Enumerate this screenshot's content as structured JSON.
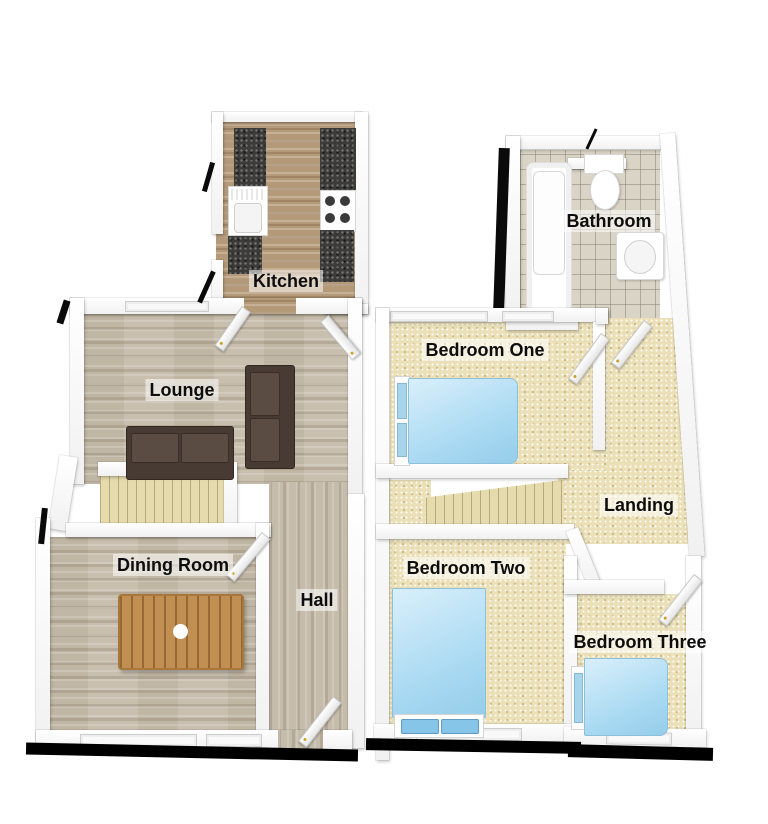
{
  "floorplan": {
    "style": "3d-rendered-floorplan",
    "floors": [
      {
        "id": "ground-floor",
        "rooms": [
          {
            "id": "kitchen",
            "label": "Kitchen",
            "floor_finish": "wood",
            "furniture": [
              "worktop",
              "kitchen-sink",
              "hob"
            ]
          },
          {
            "id": "lounge",
            "label": "Lounge",
            "floor_finish": "wood",
            "furniture": [
              "sofa-large",
              "sofa-small"
            ]
          },
          {
            "id": "dining-room",
            "label": "Dining Room",
            "floor_finish": "wood",
            "furniture": [
              "dining-table"
            ]
          },
          {
            "id": "hall",
            "label": "Hall",
            "floor_finish": "wood",
            "furniture": [
              "staircase",
              "front-door"
            ]
          }
        ]
      },
      {
        "id": "first-floor",
        "rooms": [
          {
            "id": "bathroom",
            "label": "Bathroom",
            "floor_finish": "tile",
            "furniture": [
              "bathtub",
              "toilet",
              "wash-basin"
            ]
          },
          {
            "id": "bedroom-one",
            "label": "Bedroom One",
            "floor_finish": "carpet",
            "furniture": [
              "double-bed"
            ]
          },
          {
            "id": "landing",
            "label": "Landing",
            "floor_finish": "carpet",
            "furniture": [
              "staircase"
            ]
          },
          {
            "id": "bedroom-two",
            "label": "Bedroom Two",
            "floor_finish": "carpet",
            "furniture": [
              "double-bed"
            ]
          },
          {
            "id": "bedroom-three",
            "label": "Bedroom Three",
            "floor_finish": "carpet",
            "furniture": [
              "single-bed"
            ]
          }
        ]
      }
    ],
    "colors": {
      "background": "#ffffff",
      "wall": "#ffffff",
      "wall_shade": "#f1f1f1",
      "outline_shadow": "#000000",
      "wood_floor": "#c8bfae",
      "kitchen_floor": "#b59a79",
      "carpet": "#eadfb6",
      "tile": "#d9d4c6",
      "stairs": "#e6dbad",
      "bed_blue": "#a8d9f2",
      "sofa_brown": "#473b33",
      "worktop_dark": "#3c3b39",
      "table_wood": "#c18f52",
      "label_text": "#0d0d0d",
      "label_bg": "rgba(255,255,255,0.55)"
    }
  }
}
